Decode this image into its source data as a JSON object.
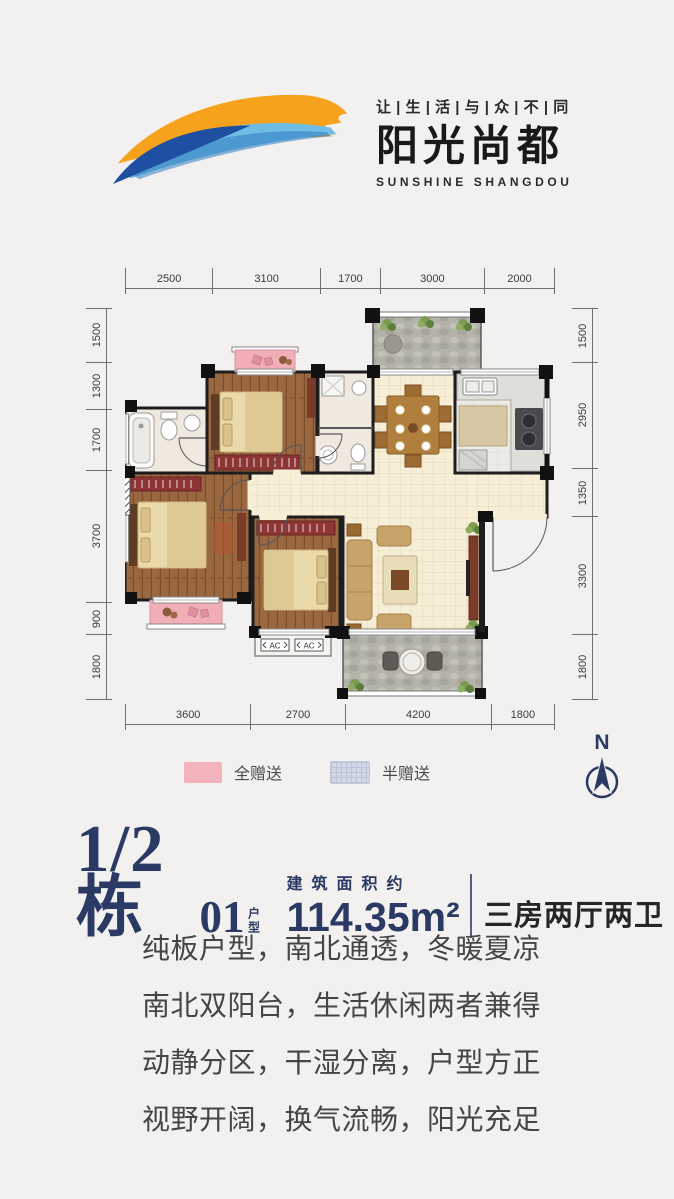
{
  "header": {
    "tagline": "让 | 生 | 活 | 与 | 众 | 不 | 同",
    "brand_cn": "阳光尚都",
    "brand_en": "SUNSHINE SHANGDOU"
  },
  "plan": {
    "dims": {
      "top": [
        "2500",
        "3100",
        "1700",
        "3000",
        "2000"
      ],
      "bottom": [
        "3600",
        "2700",
        "4200",
        "1800"
      ],
      "left": [
        "1500",
        "1300",
        "1700",
        "3700",
        "900",
        "1800"
      ],
      "right": [
        "1500",
        "2950",
        "1350",
        "3300",
        "1800"
      ]
    },
    "ac_label": "AC",
    "legend": [
      {
        "label": "全赠送",
        "color": "#f2b3bc"
      },
      {
        "label": "半赠送",
        "color": "#d4d8e4"
      }
    ],
    "compass_label": "N"
  },
  "title": {
    "block": "1/2栋",
    "unit": "01",
    "unit_type": "户型",
    "area_label": "建筑面积约",
    "area_value": "114.35m²",
    "layout": "三房两厅两卫"
  },
  "description": {
    "lines": [
      "纯板户型，南北通透，冬暖夏凉",
      "南北双阳台，生活休闲两者兼得",
      "动静分区，干湿分离，户型方正",
      "视野开阔，换气流畅，阳光充足"
    ]
  },
  "colors": {
    "navy": "#2b3a64",
    "orange": "#f6a21d",
    "blue_dark": "#1e4fa0",
    "blue_light": "#6fbce4",
    "gift_pink": "#f2aeb7",
    "half_gift_blue": "#d4d8e4"
  }
}
